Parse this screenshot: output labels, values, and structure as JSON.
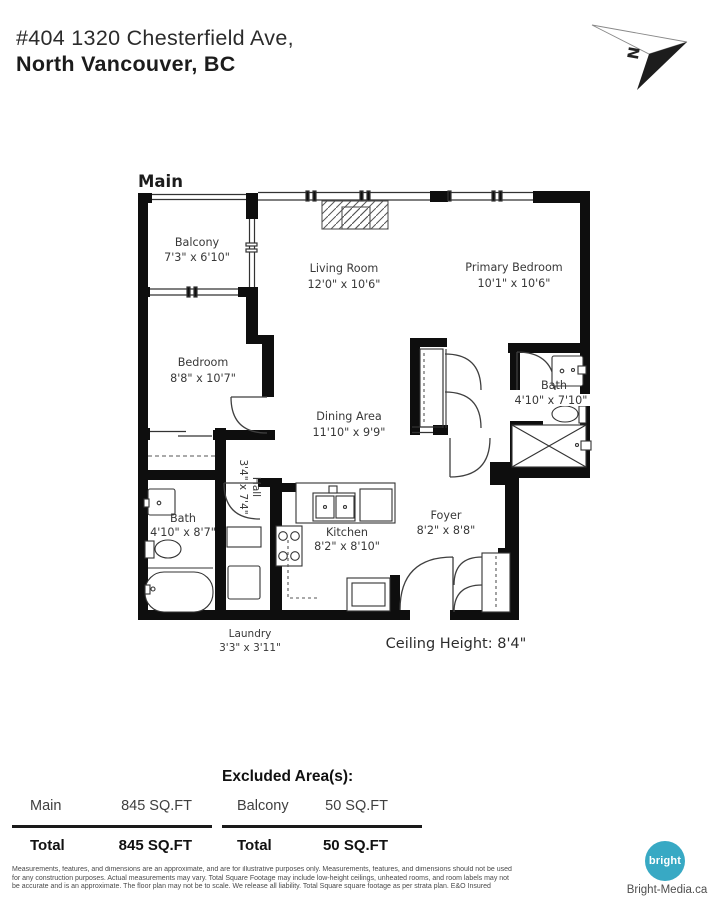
{
  "header": {
    "address_line1": "#404 1320 Chesterfield Ave,",
    "address_line2": "North Vancouver, BC"
  },
  "compass": {
    "label": "N"
  },
  "plan": {
    "title": "Main",
    "ceiling_height": "Ceiling Height: 8'4\"",
    "rooms": {
      "balcony": {
        "name": "Balcony",
        "dims": "7'3\" x 6'10\""
      },
      "living_room": {
        "name": "Living Room",
        "dims": "12'0\" x 10'6\""
      },
      "primary_bedroom": {
        "name": "Primary Bedroom",
        "dims": "10'1\" x 10'6\""
      },
      "bedroom": {
        "name": "Bedroom",
        "dims": "8'8\" x 10'7\""
      },
      "dining_area": {
        "name": "Dining Area",
        "dims": "11'10\" x 9'9\""
      },
      "bath_primary": {
        "name": "Bath",
        "dims": "4'10\" x 7'10\""
      },
      "bath_main": {
        "name": "Bath",
        "dims": "4'10\" x 8'7\""
      },
      "hall": {
        "name": "Hall",
        "dims": "3'4\" x 7'4\""
      },
      "kitchen": {
        "name": "Kitchen",
        "dims": "8'2\" x 8'10\""
      },
      "foyer": {
        "name": "Foyer",
        "dims": "8'2\" x 8'8\""
      },
      "laundry": {
        "name": "Laundry",
        "dims": "3'3\" x 3'11\""
      }
    }
  },
  "summary": {
    "left": {
      "rows": [
        {
          "label": "Main",
          "value": "845 SQ.FT"
        }
      ],
      "total_label": "Total",
      "total_value": "845 SQ.FT"
    },
    "right": {
      "header": "Excluded Area(s):",
      "rows": [
        {
          "label": "Balcony",
          "value": "50 SQ.FT"
        }
      ],
      "total_label": "Total",
      "total_value": "50 SQ.FT"
    }
  },
  "disclaimer": [
    "Measurements, features, and dimensions are an approximate, and are for illustrative purposes only. Measurements, features, and dimensions should not be used",
    "for any construction purposes. Actual measurements may vary. Total Square Footage may include low-height ceilings, unheated rooms, and room labels may not",
    "be accurate and is an approximate. The floor plan may not be to scale. We release all liability. Total Square square footage as per strata plan. E&O Insured"
  ],
  "branding": {
    "logo_text": "bright",
    "website": "Bright-Media.ca",
    "logo_color": "#38A9C4"
  }
}
